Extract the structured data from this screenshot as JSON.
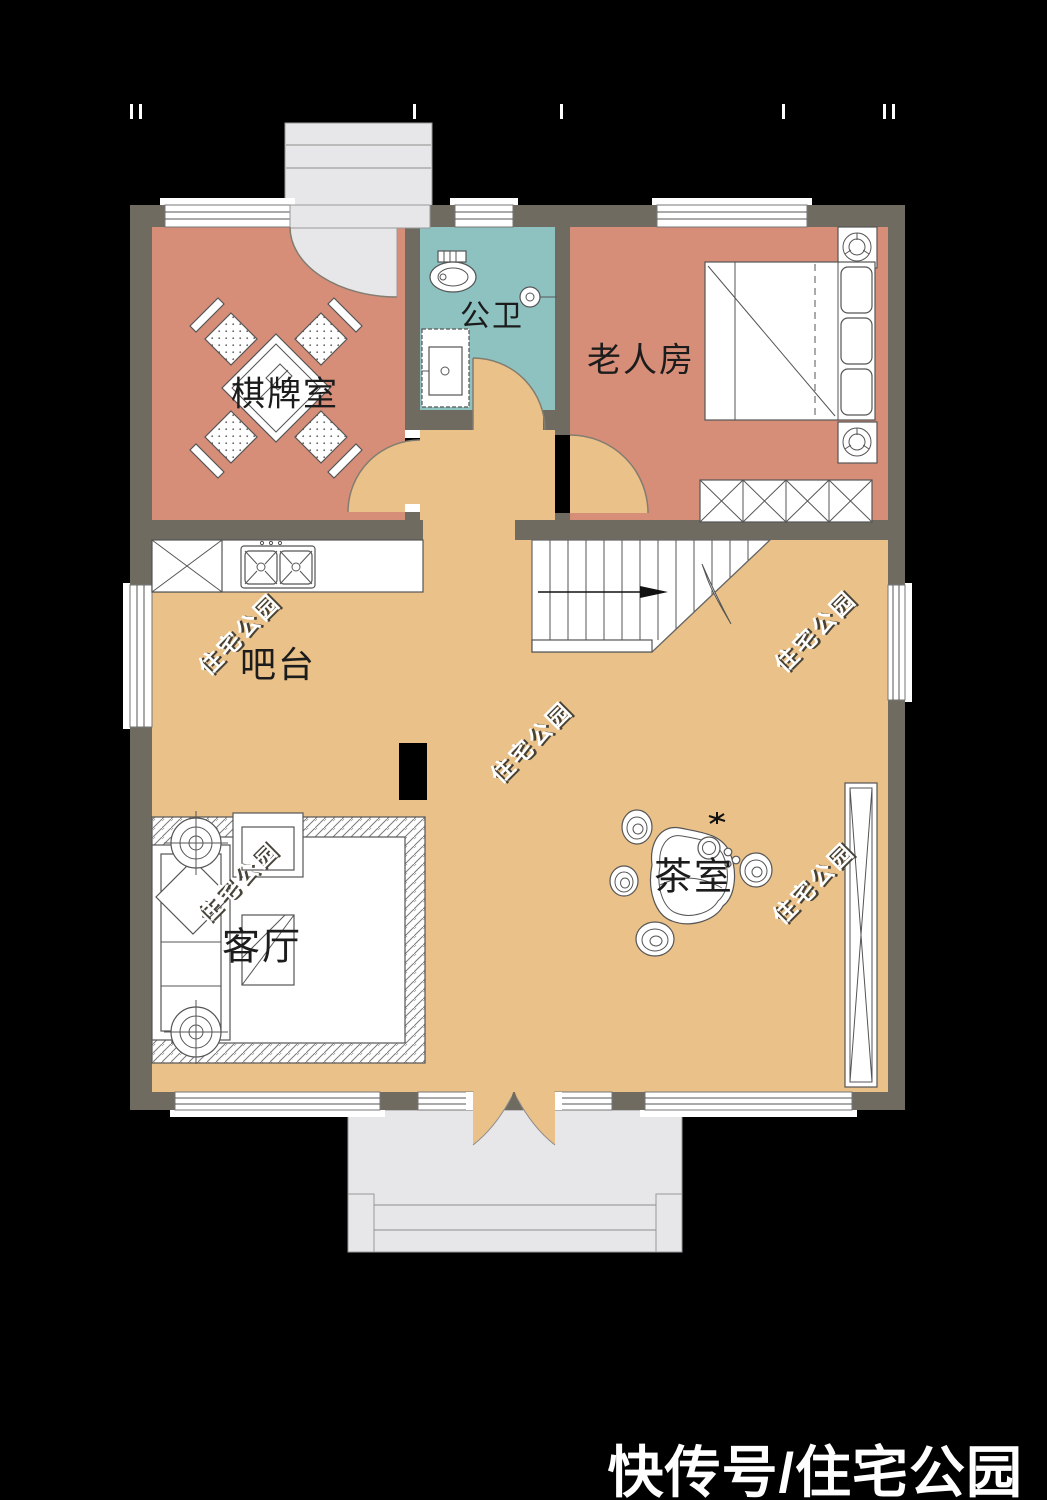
{
  "caption": {
    "text": "快传号/住宅公园"
  },
  "watermark": {
    "text": "住宅公园"
  },
  "rooms": {
    "chess": {
      "label": "棋牌室"
    },
    "bath": {
      "label": "公卫"
    },
    "elder": {
      "label": "老人房"
    },
    "bar": {
      "label": "吧台"
    },
    "living": {
      "label": "客厅"
    },
    "tea": {
      "label": "茶室"
    }
  },
  "colors": {
    "bg": "#000000",
    "wall": "#6f6b60",
    "salmon": "#d78e79",
    "teal": "#8ec2c1",
    "tan": "#e9c189",
    "porch": "#e7e7e9"
  }
}
